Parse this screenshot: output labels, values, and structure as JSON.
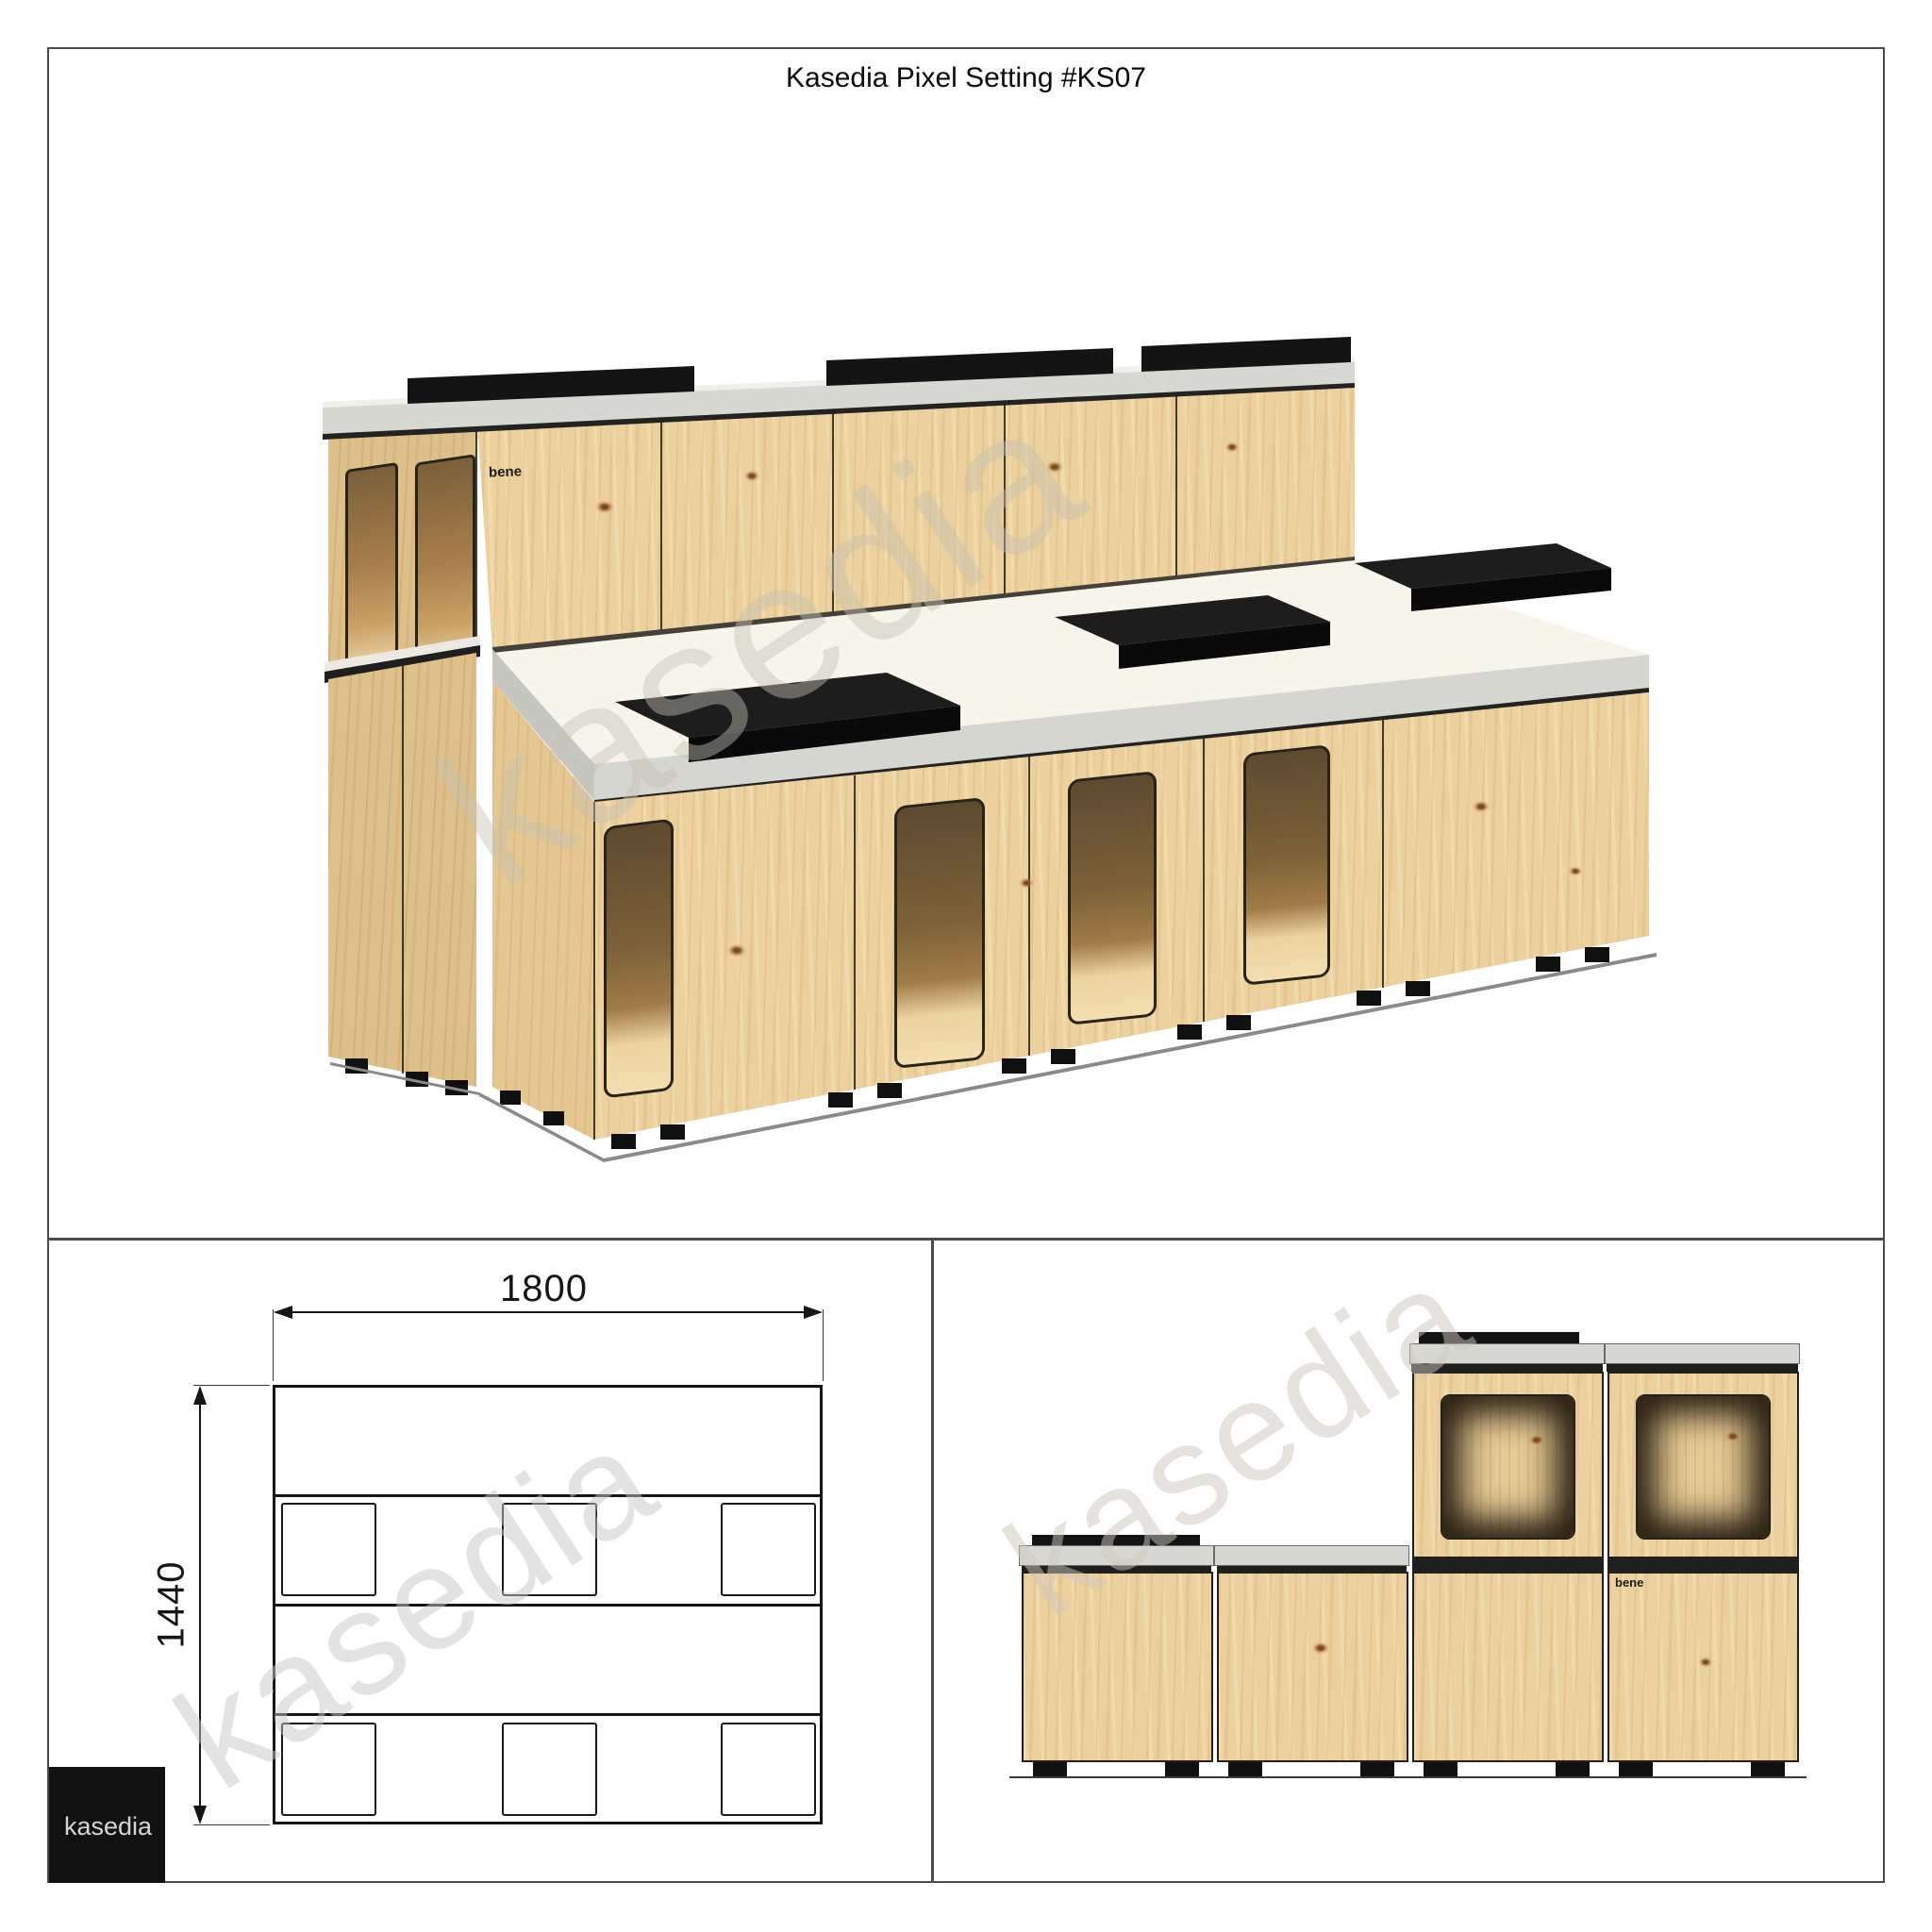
{
  "page": {
    "title": "Kasedia Pixel Setting #KS07"
  },
  "watermark": {
    "text": "kasedia"
  },
  "logo": {
    "brand": "kasedia",
    "product": "bene"
  },
  "front_elevation": {
    "width_mm": "1800",
    "height_mm": "1440"
  },
  "colors": {
    "wood": "#ecd09d",
    "slab_gray": "#d8d8d2",
    "deck_white": "#f7f5ea",
    "cushion_black": "#141414",
    "line": "#1f1f1f",
    "frame_border": "#4a4a4a",
    "logo_bg": "#121212",
    "logo_text": "#d6d6d6"
  }
}
